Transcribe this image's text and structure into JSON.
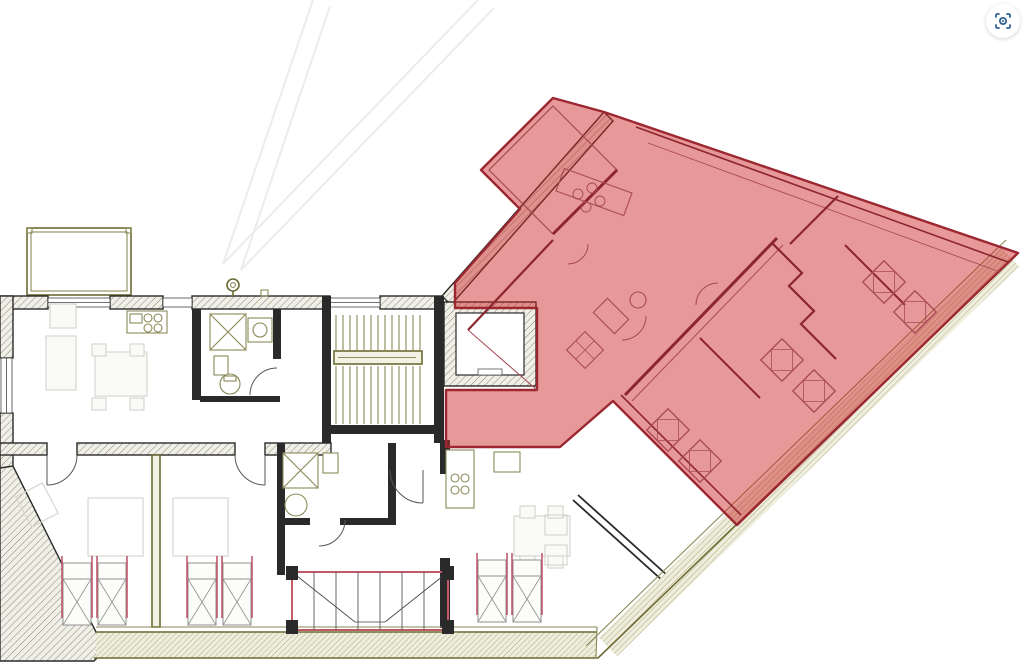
{
  "canvas": {
    "width": 1024,
    "height": 672
  },
  "toolbar": {
    "lens_button": {
      "icon": "lens-icon",
      "icon_color": "#2e6293",
      "background": "#ffffff"
    }
  },
  "colors": {
    "bg": "#ffffff",
    "hl_fill": "rgba(203,36,36,0.47)",
    "hl_border": "#9c2730",
    "wall_dark": "#2a2a2a",
    "wall_olive": "#6b6b33",
    "line_olive": "#8a8a58",
    "furn_faint": "#d6d6d0",
    "bed_accent": "#c05a6e",
    "wing_dark": "#8c2530",
    "wing_mid": "#a84a52",
    "void_border": "#bf5a66",
    "hatch_bg": "#f0efe8",
    "hatch_line": "#8b8b74"
  },
  "highlight": {
    "path": "M604,112 L1018,253 L737,525 L613,401 L560,447 L446,447 L446,390 L537,390 L537,308 L455,308 L455,283 L520,209 L481,170 L553,98 Z",
    "terrace_outline": "M553,106 L617,170 L553,234 L489,170 Z"
  }
}
